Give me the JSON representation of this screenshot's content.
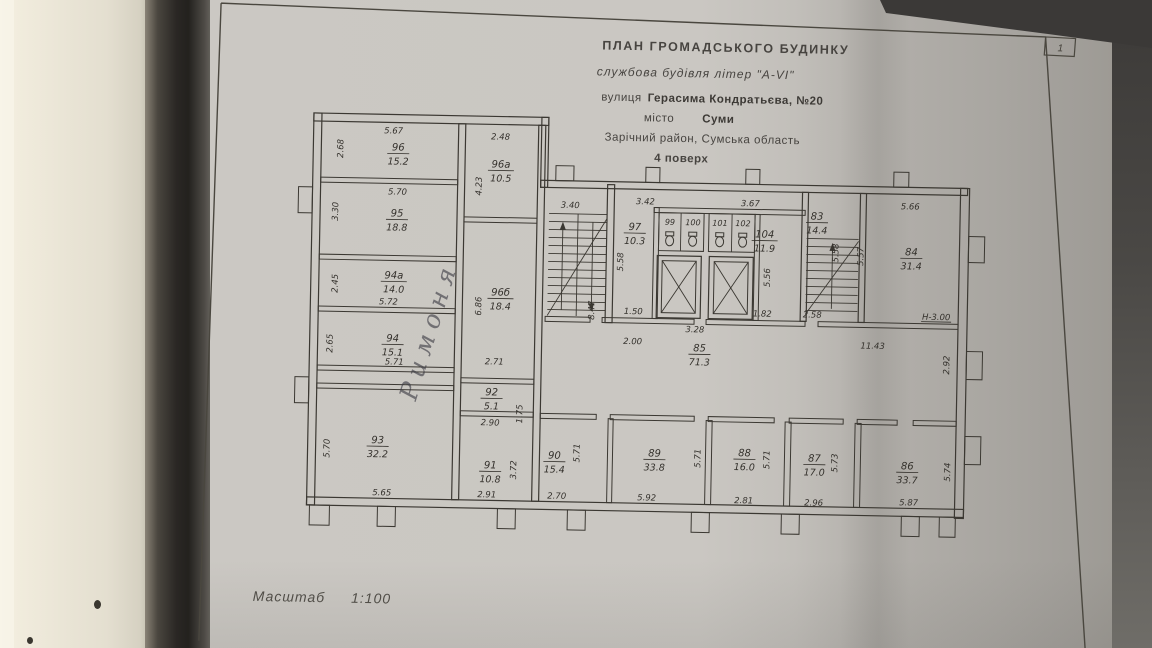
{
  "header": {
    "title": "ПЛАН  ГРОМАДСЬКОГО  БУДИНКУ",
    "subtitle": "службова будівля літер \"А-VI\"",
    "street_label": "вулиця",
    "street": "Герасима Кондратьєва, №20",
    "city_label": "місто",
    "city": "Суми",
    "district": "Зарічний район, Сумська область",
    "floor": "4 поверх"
  },
  "page_number": "1",
  "scale": {
    "label": "Масштаб",
    "value": "1:100"
  },
  "handwritten_note": "Римоня",
  "colors": {
    "paper": "#c9c6c1",
    "ink": "#3b3832",
    "wall_bg": "#ece7d8",
    "shadow": "#23211e"
  },
  "rooms": {
    "r96": {
      "number": "96",
      "area": "15.2"
    },
    "r96a": {
      "number": "96а",
      "area": "10.5"
    },
    "r95": {
      "number": "95",
      "area": "18.8"
    },
    "r94a": {
      "number": "94а",
      "area": "14.0"
    },
    "r94": {
      "number": "94",
      "area": "15.1"
    },
    "r96b": {
      "number": "96б",
      "area": "18.4"
    },
    "r92": {
      "number": "92",
      "area": "5.1"
    },
    "r97": {
      "number": "97",
      "area": "10.3"
    },
    "r99": {
      "number": "99"
    },
    "r100": {
      "number": "100"
    },
    "r101": {
      "number": "101"
    },
    "r102": {
      "number": "102"
    },
    "r104": {
      "number": "104",
      "area": "11.9"
    },
    "r83": {
      "number": "83",
      "area": "14.4"
    },
    "r84": {
      "number": "84",
      "area": "31.4"
    },
    "r85": {
      "number": "85",
      "area": "71.3"
    },
    "r93": {
      "number": "93",
      "area": "32.2"
    },
    "r91": {
      "number": "91",
      "area": "10.8"
    },
    "r90": {
      "number": "90",
      "area": "15.4"
    },
    "r89": {
      "number": "89",
      "area": "33.8"
    },
    "r88": {
      "number": "88",
      "area": "16.0"
    },
    "r87": {
      "number": "87",
      "area": "17.0"
    },
    "r86": {
      "number": "86",
      "area": "33.7"
    }
  },
  "dims": {
    "r96_top": "5.67",
    "r96_left": "2.68",
    "r96a_top": "2.48",
    "r96a_left": "4.23",
    "r95_top": "5.70",
    "r95_left": "3.30",
    "r94a_left": "2.45",
    "r94a_bottom": "5.72",
    "r94_left": "2.65",
    "r94_bottom": "5.71",
    "r96b_left": "6.86",
    "hall_top": "2.71",
    "r92_bottom": "2.90",
    "r92_right": "1.75",
    "stair_top": "3.40",
    "stair_left": "8.47",
    "r97_top": "3.42",
    "r97_left": "5.58",
    "r97_bottom": "1.50",
    "corr_left": "2.00",
    "elev_bottom": "3.28",
    "r104_top": "3.67",
    "r104_right": "5.56",
    "r104_bottom": "1.82",
    "r83_left": "5.58",
    "r83_bottom": "2.58",
    "r84_left": "5.57",
    "r84_top": "5.66",
    "r84_height": "Н-3.00",
    "corr_right": "11.43",
    "right_wall": "2.92",
    "r93_left": "5.70",
    "r93_bottom": "5.65",
    "r91_bottom": "2.91",
    "r91_right": "3.72",
    "r90_bottom": "2.70",
    "r90_right": "5.71",
    "r89_bottom": "5.92",
    "r89_right": "5.71",
    "r88_bottom": "2.81",
    "r88_right": "5.71",
    "r87_bottom": "2.96",
    "r87_right": "5.73",
    "r86_bottom": "5.87",
    "r86_right": "5.74"
  }
}
